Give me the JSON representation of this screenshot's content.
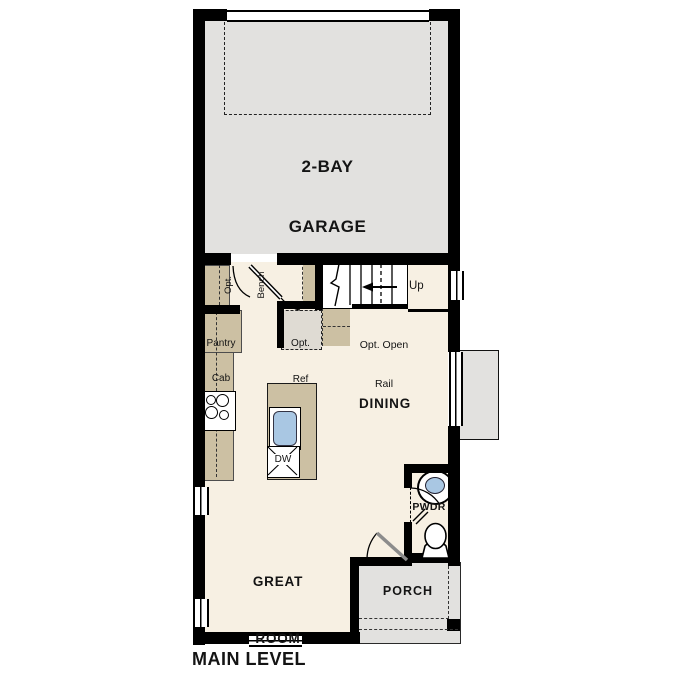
{
  "plan_title": "MAIN LEVEL",
  "rooms": {
    "garage": {
      "name_line1": "2-BAY",
      "name_line2": "GARAGE"
    },
    "dining": {
      "name": "DINING"
    },
    "great_room": {
      "name_line1": "GREAT",
      "name_line2": "ROOM"
    },
    "powder_room": {
      "name": "PWDR"
    },
    "porch": {
      "name": "PORCH"
    }
  },
  "annotations": {
    "stairs_up": "Up",
    "opt_bench_line1": "Opt.",
    "opt_bench_line2": "Bench",
    "pantry_line1": "Pantry",
    "pantry_line2": "Cab",
    "opt_ref_line1": "Opt.",
    "opt_ref_line2": "Ref",
    "opt_open_rail_line1": "Opt. Open",
    "opt_open_rail_line2": "Rail",
    "dishwasher": "DW"
  },
  "colors": {
    "wall": "#000000",
    "interior_floor": "#f7f0e3",
    "garage_floor": "#e2e1df",
    "porch_floor": "#e2e1df",
    "cabinet_tan": "#ccc0a3",
    "optional_item_fill": "#dfdbd3",
    "sink_blue": "#a9c7e3",
    "door_leaf_gray": "#8c8c8c"
  }
}
